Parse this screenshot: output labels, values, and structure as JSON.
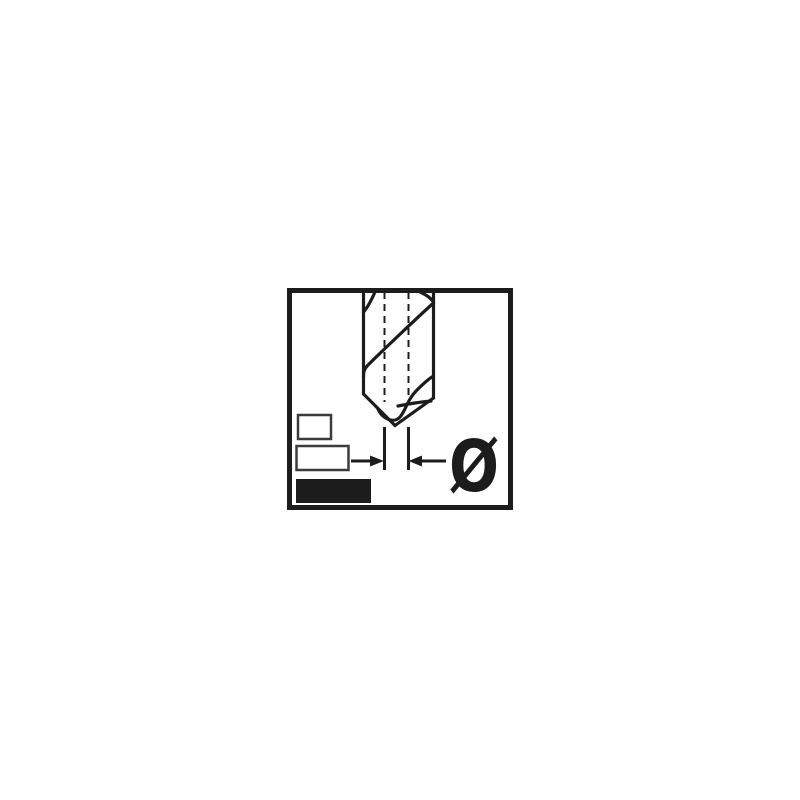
{
  "diagram": {
    "diameter_symbol": "Ø",
    "ink_color": "#1c1c1c",
    "outline_gray": "#3c3c3c",
    "background_color": "#ffffff",
    "icons": {
      "main": "twist-drill-bit-side-view-icon",
      "dimension": "inward-dimension-arrows-icon",
      "symbol_meaning": "diameter-symbol"
    }
  }
}
